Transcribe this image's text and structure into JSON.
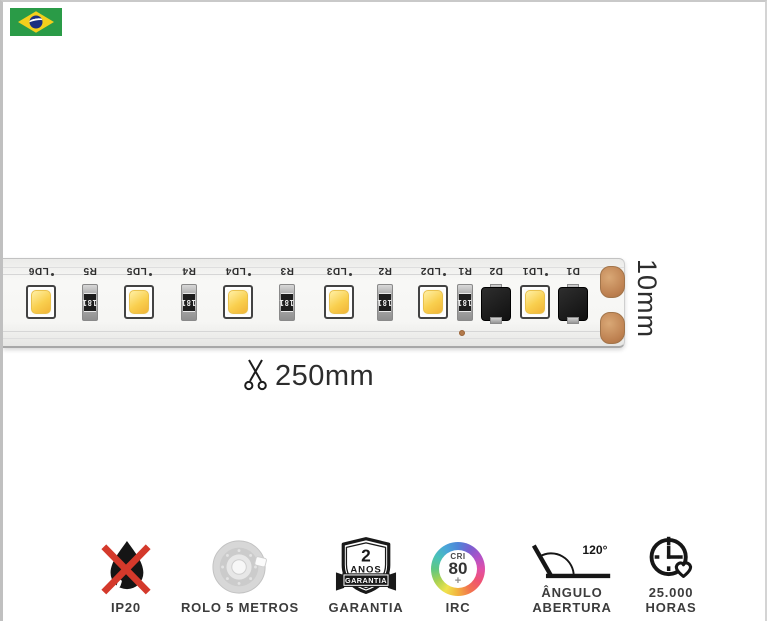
{
  "strip": {
    "width_label": "10mm",
    "cut_length_label": "250mm",
    "resistor_value": "181",
    "components": [
      {
        "type": "led",
        "label": "LD6"
      },
      {
        "type": "resistor",
        "label": "R5"
      },
      {
        "type": "led",
        "label": "LD5"
      },
      {
        "type": "resistor",
        "label": "R4"
      },
      {
        "type": "led",
        "label": "LD4"
      },
      {
        "type": "resistor",
        "label": "R3"
      },
      {
        "type": "led",
        "label": "LD3"
      },
      {
        "type": "resistor",
        "label": "R2"
      },
      {
        "type": "led",
        "label": "LD2"
      },
      {
        "type": "resistor",
        "label": "R1"
      },
      {
        "type": "diode",
        "label": "D2"
      },
      {
        "type": "led",
        "label": "LD1"
      },
      {
        "type": "diode",
        "label": "D1"
      }
    ]
  },
  "features": {
    "ip20": {
      "label": "IP20"
    },
    "roll": {
      "label": "ROLO 5 METROS"
    },
    "warranty": {
      "label": "GARANTIA",
      "badge_value": "2",
      "badge_unit": "ANOS",
      "badge_ribbon": "GARANTIA"
    },
    "cri": {
      "label": "IRC",
      "top": "CRI",
      "value": "80",
      "plus": "+"
    },
    "angle": {
      "label_line1": "ÂNGULO",
      "label_line2": "ABERTURA",
      "value": "120°"
    },
    "lifespan": {
      "label_line1": "25.000",
      "label_line2": "HORAS"
    }
  },
  "colors": {
    "accent_red": "#d4392b",
    "copper": "#bd8050",
    "led_yellow": "#f9cf4e",
    "flag_green": "#2a9b47",
    "flag_yellow": "#f3cf1c",
    "flag_blue": "#1b2f80"
  }
}
